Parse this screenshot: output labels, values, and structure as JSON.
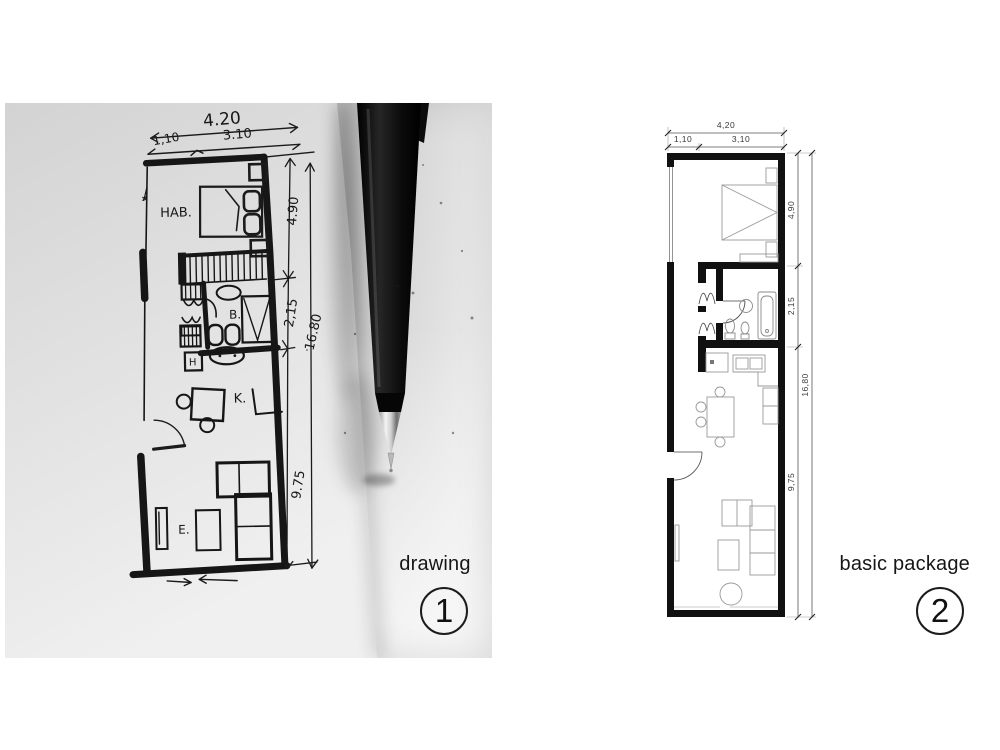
{
  "colors": {
    "page_bg": "#ffffff",
    "photo_base": "#cdcdcd",
    "sketch_ink": "#1b1b1b",
    "cad_wall": "#111111",
    "cad_furniture": "#9a9a9a",
    "caption_text": "#161616"
  },
  "left_panel": {
    "caption": {
      "label": "drawing",
      "number": "1"
    },
    "sketch": {
      "dims": {
        "width_total": "4.20",
        "width_left": "1,10",
        "width_right": "3.10",
        "height_bedroom": "4.90",
        "height_bath": "2,15",
        "height_living": "9.75",
        "height_total": "16.80"
      },
      "rooms": {
        "bedroom": "HAB.",
        "bathroom": "B.",
        "hall": "H",
        "kitchen": "K.",
        "living": "E."
      }
    }
  },
  "right_panel": {
    "caption": {
      "label": "basic package",
      "number": "2"
    },
    "plan": {
      "dims": {
        "width_total": "4,20",
        "width_left": "1,10",
        "width_right": "3,10",
        "height_bedroom": "4,90",
        "height_bath": "2,15",
        "height_living": "9,75",
        "height_total": "16,80"
      }
    }
  }
}
